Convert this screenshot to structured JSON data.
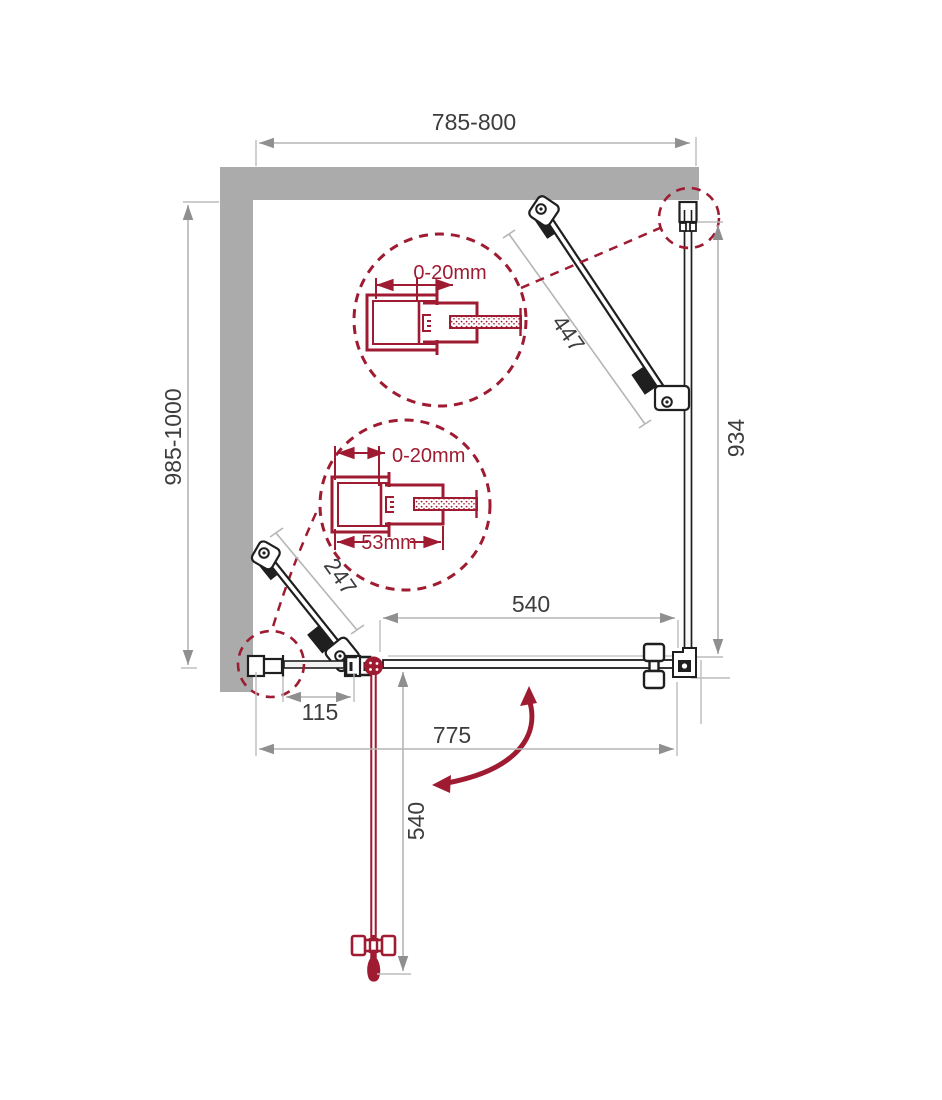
{
  "diagram": {
    "type": "shower-enclosure-installation-drawing",
    "colors": {
      "accent": "#9e1b31",
      "wall": "#ababab",
      "line": "#1f1f1f",
      "dim_line": "#b5b5b5",
      "dim_text": "#3d3d3d"
    },
    "dimensions": {
      "overall_width": "785-800",
      "overall_depth": "985-1000",
      "support_bar_right": "447",
      "side_panel": "934",
      "opening_width": "540",
      "wall_segment": "115",
      "front_width": "775",
      "door_width": "540",
      "support_bar_left": "247"
    },
    "details": {
      "detail_top": {
        "adjustment": "0-20mm"
      },
      "detail_bottom": {
        "adjustment": "0-20mm",
        "profile_width": "53mm"
      }
    }
  }
}
